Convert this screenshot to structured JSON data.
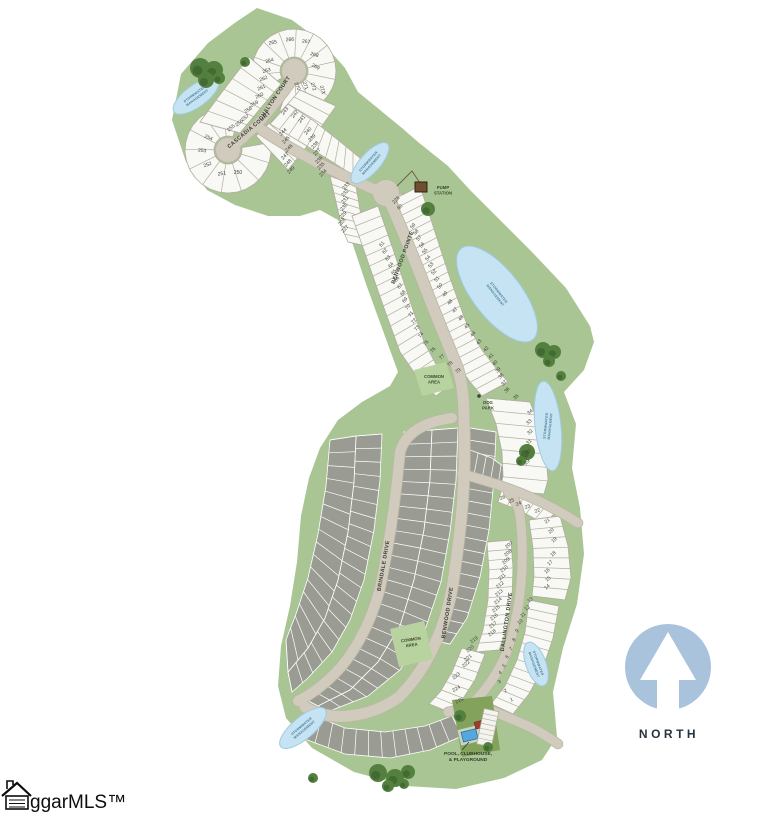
{
  "north": {
    "label": "NORTH"
  },
  "watermark": {
    "text": "ggarMLS™"
  },
  "colors": {
    "land": "#a8c593",
    "road": "#d1cbbd",
    "road_edge": "#bdb6a6",
    "lot_white": "#f8f8f4",
    "lot_gray": "#9a9b93",
    "water": "#c5e3f2",
    "water_edge": "#9fcbe2",
    "tree": "#53803f",
    "tree_dark": "#446a33",
    "north_blue": "#a9c3dc",
    "label_dark": "#3f4238",
    "poi_green": "#3b4a2f",
    "water_text": "#4a7d99",
    "pump_brown": "#6f4e32",
    "building_red": "#a23a2e",
    "pool_blue": "#55a8dd"
  },
  "map": {
    "streets": [
      {
        "name": "CASCADIA COURT",
        "x": 250,
        "y": 131,
        "rot": -40
      },
      {
        "name": "CHALTON COURT",
        "x": 276,
        "y": 99,
        "rot": -56
      },
      {
        "name": "BENWOOD POINTE",
        "x": 404,
        "y": 258,
        "rot": -70
      },
      {
        "name": "BRINDALE DRIVE",
        "x": 385,
        "y": 566,
        "rot": -80
      },
      {
        "name": "BENWOOD DRIVE",
        "x": 449,
        "y": 613,
        "rot": -81
      },
      {
        "name": "DALLINGTON DRIVE",
        "x": 508,
        "y": 622,
        "rot": -82
      }
    ],
    "water_label": "STORMWATER MANAGEMENT",
    "water_bodies": [
      {
        "x": 196,
        "y": 96,
        "rx": 27,
        "ry": 11,
        "rot": -36,
        "label_rot": -36
      },
      {
        "x": 370,
        "y": 163,
        "rx": 26,
        "ry": 10,
        "rot": -48,
        "label_rot": -48
      },
      {
        "x": 497,
        "y": 294,
        "rx": 58,
        "ry": 24,
        "rot": 52,
        "label_rot": 52
      },
      {
        "x": 548,
        "y": 426,
        "rx": 45,
        "ry": 13,
        "rot": 84,
        "label_rot": -84
      },
      {
        "x": 536,
        "y": 664,
        "rx": 23,
        "ry": 10,
        "rot": 70,
        "label_rot": 70
      },
      {
        "x": 303,
        "y": 728,
        "rx": 29,
        "ry": 11,
        "rot": -40,
        "label_rot": -40
      }
    ],
    "poi": {
      "pump_station": {
        "label": "PUMP STATION",
        "x": 443,
        "y": 189
      },
      "dog_park": {
        "label": "DOG PARK",
        "x": 488,
        "y": 404
      },
      "common_areas": [
        {
          "label": "COMMON AREA",
          "x": 434,
          "y": 378,
          "rot": 0
        },
        {
          "label": "COMMON AREA",
          "x": 411,
          "y": 641,
          "rot": -8
        }
      ],
      "pool": {
        "label": "POOL, CLUBHOUSE, & PLAYGROUND",
        "x": 468,
        "y": 755
      }
    },
    "lots": [
      [
        "250",
        238,
        174,
        0
      ],
      [
        "251",
        222,
        175,
        -8
      ],
      [
        "252",
        208,
        166,
        -20
      ],
      [
        "253",
        202,
        152,
        5
      ],
      [
        "254",
        208,
        139,
        22
      ],
      [
        "255",
        232,
        129,
        -40
      ],
      [
        "256",
        240,
        124,
        -38
      ],
      [
        "257",
        246,
        119,
        -34
      ],
      [
        "258",
        249,
        111,
        -32
      ],
      [
        "259",
        255,
        105,
        -28
      ],
      [
        "260",
        260,
        97,
        -24
      ],
      [
        "261",
        262,
        89,
        -22
      ],
      [
        "262",
        264,
        80,
        -20
      ],
      [
        "263",
        267,
        72,
        -18
      ],
      [
        "264",
        270,
        62,
        -18
      ],
      [
        "265",
        273,
        44,
        -10
      ],
      [
        "266",
        290,
        41,
        -4
      ],
      [
        "267",
        306,
        43,
        6
      ],
      [
        "268",
        314,
        56,
        18
      ],
      [
        "269",
        315,
        68,
        26
      ],
      [
        "270",
        296,
        87,
        65
      ],
      [
        "271",
        304,
        86,
        70
      ],
      [
        "272",
        312,
        87,
        73
      ],
      [
        "273",
        321,
        90,
        75
      ],
      [
        "244",
        284,
        133,
        -45
      ],
      [
        "245",
        287,
        141,
        -45
      ],
      [
        "246",
        290,
        149,
        -45
      ],
      [
        "247",
        286,
        157,
        -45
      ],
      [
        "248",
        289,
        164,
        -45
      ],
      [
        "249",
        292,
        171,
        -45
      ],
      [
        "243",
        286,
        112,
        -50
      ],
      [
        "242",
        296,
        115,
        -50
      ],
      [
        "241",
        303,
        120,
        -50
      ],
      [
        "240",
        309,
        132,
        -46
      ],
      [
        "239",
        313,
        139,
        -46
      ],
      [
        "238",
        316,
        146,
        -46
      ],
      [
        "237",
        318,
        153,
        -46
      ],
      [
        "236",
        320,
        161,
        -46
      ],
      [
        "235",
        322,
        167,
        -46
      ],
      [
        "234",
        324,
        174,
        -46
      ],
      [
        "233",
        347,
        187,
        -46
      ],
      [
        "232",
        346,
        194,
        -46
      ],
      [
        "231",
        346,
        201,
        -46
      ],
      [
        "230",
        345,
        208,
        -46
      ],
      [
        "229",
        344,
        216,
        -46
      ],
      [
        "228",
        343,
        223,
        -46
      ],
      [
        "227",
        346,
        230,
        -46
      ],
      [
        "226",
        397,
        201,
        -46
      ],
      [
        "60",
        401,
        208,
        -46
      ],
      [
        "61",
        383,
        245,
        -50
      ],
      [
        "62",
        386,
        252,
        -50
      ],
      [
        "63",
        389,
        259,
        -50
      ],
      [
        "64",
        392,
        266,
        -50
      ],
      [
        "65",
        395,
        273,
        -50
      ],
      [
        "66",
        398,
        280,
        -50
      ],
      [
        "67",
        401,
        287,
        -50
      ],
      [
        "68",
        404,
        294,
        -50
      ],
      [
        "69",
        406,
        301,
        -50
      ],
      [
        "70",
        409,
        308,
        -50
      ],
      [
        "71",
        412,
        315,
        -50
      ],
      [
        "72",
        415,
        322,
        -50
      ],
      [
        "73",
        418,
        329,
        -50
      ],
      [
        "74",
        422,
        336,
        -50
      ],
      [
        "75",
        427,
        344,
        -48
      ],
      [
        "76",
        434,
        351,
        -46
      ],
      [
        "77",
        443,
        358,
        -44
      ],
      [
        "78",
        451,
        365,
        -42
      ],
      [
        "79",
        459,
        372,
        -40
      ],
      [
        "59",
        414,
        227,
        -50
      ],
      [
        "58",
        417,
        233,
        -50
      ],
      [
        "57",
        420,
        239,
        -50
      ],
      [
        "56",
        423,
        246,
        -50
      ],
      [
        "55",
        426,
        252,
        -50
      ],
      [
        "54",
        429,
        259,
        -50
      ],
      [
        "53",
        432,
        266,
        -50
      ],
      [
        "52",
        435,
        273,
        -50
      ],
      [
        "51",
        438,
        280,
        -50
      ],
      [
        "50",
        441,
        287,
        -50
      ],
      [
        "49",
        446,
        295,
        -50
      ],
      [
        "48",
        451,
        303,
        -50
      ],
      [
        "47",
        456,
        311,
        -50
      ],
      [
        "46",
        462,
        319,
        -48
      ],
      [
        "45",
        468,
        327,
        -48
      ],
      [
        "44",
        474,
        335,
        -48
      ],
      [
        "43",
        480,
        343,
        -48
      ],
      [
        "42",
        487,
        350,
        -46
      ],
      [
        "41",
        492,
        357,
        -46
      ],
      [
        "40",
        496,
        364,
        -46
      ],
      [
        "39",
        499,
        371,
        -46
      ],
      [
        "38",
        502,
        377,
        -46
      ],
      [
        "37",
        505,
        384,
        -46
      ],
      [
        "36",
        508,
        391,
        -46
      ],
      [
        "35",
        517,
        398,
        -44
      ],
      [
        "34",
        531,
        413,
        -42
      ],
      [
        "33",
        530,
        423,
        -42
      ],
      [
        "32",
        531,
        433,
        -42
      ],
      [
        "31",
        530,
        443,
        -42
      ],
      [
        "30",
        529,
        453,
        -42
      ],
      [
        "29",
        528,
        463,
        -42
      ],
      [
        "26",
        503,
        499,
        -20
      ],
      [
        "25",
        512,
        502,
        -20
      ],
      [
        "24",
        519,
        505,
        -20
      ],
      [
        "23",
        528,
        508,
        -20
      ],
      [
        "22",
        538,
        512,
        -22
      ],
      [
        "21",
        548,
        522,
        -35
      ],
      [
        "20",
        552,
        532,
        -38
      ],
      [
        "19",
        555,
        541,
        -40
      ],
      [
        "18",
        554,
        555,
        -40
      ],
      [
        "17",
        551,
        564,
        -40
      ],
      [
        "16",
        548,
        572,
        -40
      ],
      [
        "15",
        549,
        580,
        -40
      ],
      [
        "14",
        548,
        588,
        -40
      ],
      [
        "207",
        510,
        546,
        -40
      ],
      [
        "208",
        509,
        554,
        -40
      ],
      [
        "209",
        507,
        562,
        -40
      ],
      [
        "210",
        505,
        570,
        -40
      ],
      [
        "211",
        503,
        578,
        -40
      ],
      [
        "212",
        501,
        586,
        -40
      ],
      [
        "213",
        500,
        594,
        -40
      ],
      [
        "214",
        499,
        602,
        -40
      ],
      [
        "215",
        497,
        610,
        -40
      ],
      [
        "216",
        495,
        618,
        -40
      ],
      [
        "217",
        494,
        626,
        -40
      ],
      [
        "218",
        493,
        634,
        -40
      ],
      [
        "13",
        531,
        601,
        -40
      ],
      [
        "12",
        528,
        609,
        -40
      ],
      [
        "11",
        524,
        616,
        -40
      ],
      [
        "10",
        521,
        623,
        -40
      ],
      [
        "9",
        518,
        632,
        -40
      ],
      [
        "8",
        515,
        641,
        -40
      ],
      [
        "7",
        512,
        650,
        -40
      ],
      [
        "6",
        508,
        658,
        -38
      ],
      [
        "5",
        505,
        667,
        -36
      ],
      [
        "4",
        501,
        674,
        -34
      ],
      [
        "3",
        500,
        683,
        -30
      ],
      [
        "2",
        506,
        692,
        -25
      ],
      [
        "1",
        512,
        701,
        -20
      ],
      [
        "219",
        475,
        641,
        -40
      ],
      [
        "220",
        471,
        650,
        -40
      ],
      [
        "221",
        469,
        659,
        -40
      ],
      [
        "222",
        467,
        665,
        -40
      ],
      [
        "223",
        457,
        677,
        -38
      ],
      [
        "224",
        457,
        690,
        -30
      ],
      [
        "225",
        460,
        702,
        -22
      ]
    ]
  }
}
